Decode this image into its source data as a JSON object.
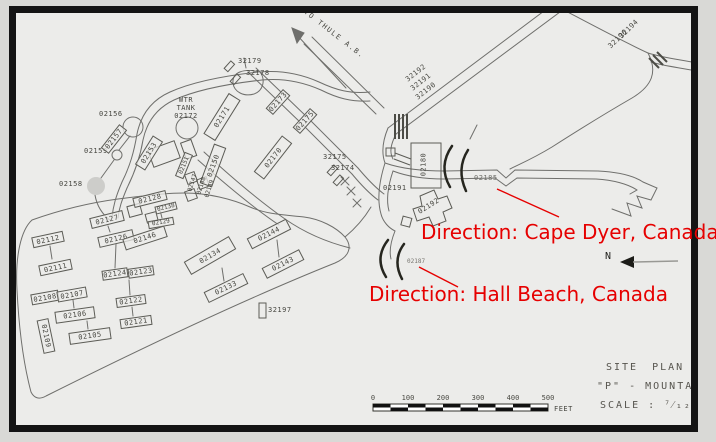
{
  "map": {
    "road_signs": {
      "to_thule": "TO THULE A.B."
    },
    "water_tank": {
      "l1": "WTR",
      "l2": "TANK",
      "l3": "02172"
    },
    "labels": {
      "32179": "32179",
      "32178": "32178",
      "02156": "02156",
      "02157": "02157",
      "02159": "02159",
      "02158": "02158",
      "02153": "02153",
      "02151": "02151",
      "02150": "02150",
      "02171": "02171",
      "02173": "02173",
      "02175": "02175",
      "02170": "02170",
      "32192": "32192",
      "32191": "32191",
      "32190": "32190",
      "32194": "32194",
      "32196": "32196",
      "32175": "32175",
      "32174": "32174",
      "02180": "02180",
      "02191": "02191",
      "02192": "02192",
      "02185": "02185",
      "02187": "02187",
      "021cut": "021",
      "02147": "02147",
      "02148": "02148",
      "02149": "02149",
      "02128": "02128",
      "02138": "02138",
      "02129": "02129",
      "02127": "02127",
      "02126": "02126",
      "02112": "02112",
      "02111": "02111",
      "02146": "02146",
      "02144": "02144",
      "02143": "02143",
      "02134": "02134",
      "02133": "02133",
      "02124": "02124",
      "02123": "02123",
      "02122": "02122",
      "02121": "02121",
      "02108": "02108",
      "02107": "02107",
      "02106": "02106",
      "02105": "02105",
      "02109": "02109",
      "32197": "32197"
    }
  },
  "annotations": {
    "cape_dyer": "Direction: Cape Dyer, Canada",
    "hall_beach": "Direction: Hall Beach, Canada",
    "color": "#e60000"
  },
  "compass": {
    "north": "N"
  },
  "scale_bar": {
    "t0": "0",
    "t100": "100",
    "t200": "200",
    "t300": "300",
    "t400": "400",
    "t500": "500",
    "unit": "FEET"
  },
  "title_block": {
    "line1": "SITE PLAN",
    "line2": "\"P\" - MOUNTAIN",
    "line3": "SCALE : ⁷⁄₁₂″"
  }
}
